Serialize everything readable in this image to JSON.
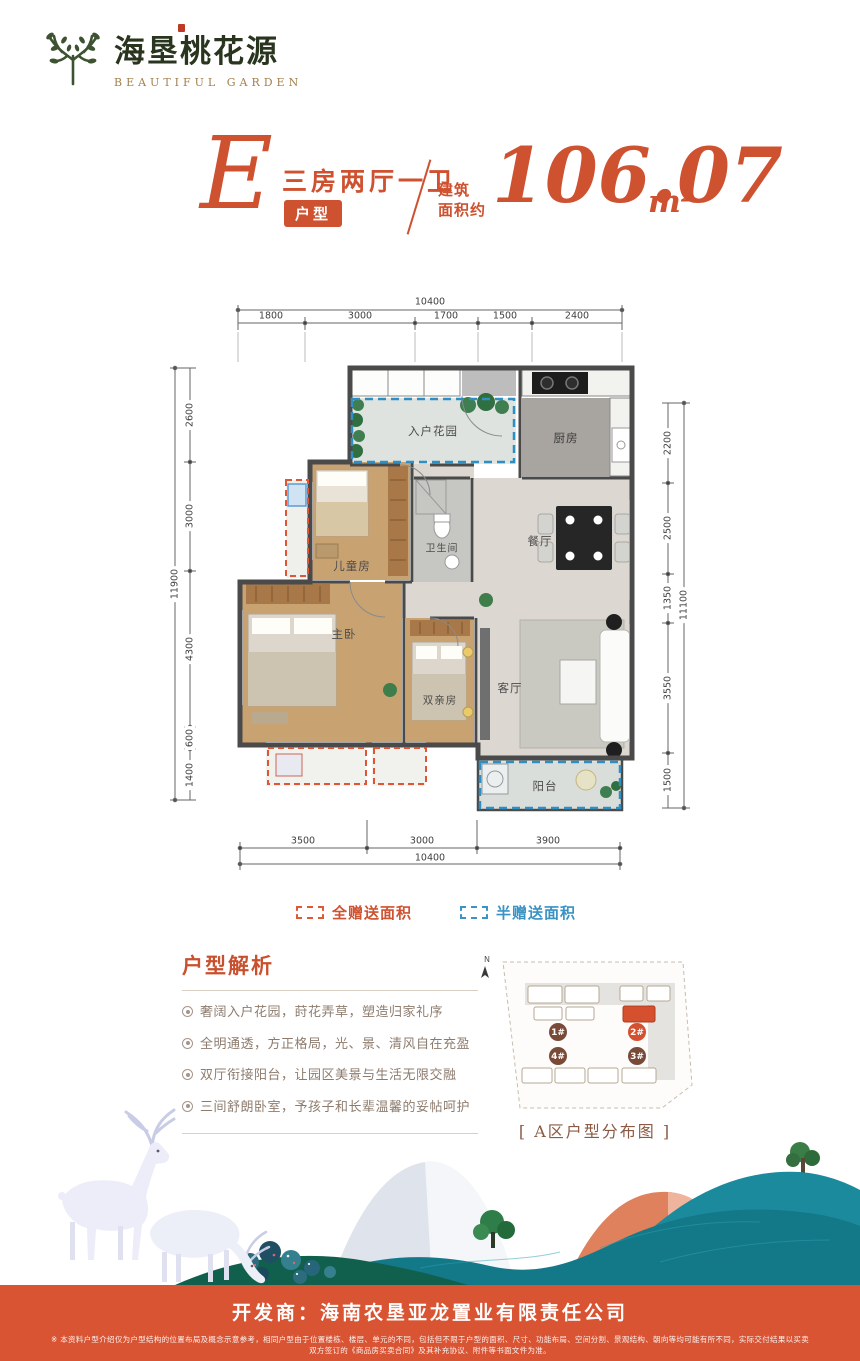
{
  "brand": {
    "name_cn": "海垦桃花源",
    "name_en": "BEAUTIFUL GARDEN"
  },
  "headline": {
    "letter": "E",
    "badge": "户型",
    "rooms_desc": "三房两厅一卫",
    "area_label_line1": "建筑",
    "area_label_line2": "面积约",
    "area_value": "106.07",
    "area_unit": "m²"
  },
  "plan": {
    "rooms": {
      "garden": "入户花园",
      "kitchen": "厨房",
      "kids": "儿童房",
      "bath": "卫生间",
      "dining": "餐厅",
      "master": "主卧",
      "parents": "双亲房",
      "living": "客厅",
      "balcony": "阳台"
    },
    "dims": {
      "top": {
        "total": "10400",
        "segs": [
          "1800",
          "3000",
          "1700",
          "1500",
          "2400"
        ]
      },
      "bottom": {
        "total": "10400",
        "segs": [
          "3500",
          "3000",
          "3900"
        ]
      },
      "left": {
        "total": "11900",
        "segs": [
          "2600",
          "3000",
          "4300",
          "600",
          "1400"
        ]
      },
      "right": {
        "total": "11100",
        "segs": [
          "2200",
          "2500",
          "1350",
          "3550",
          "1500"
        ]
      }
    }
  },
  "legend": {
    "full": "全赠送面积",
    "half": "半赠送面积"
  },
  "analysis": {
    "title": "户型解析",
    "points": [
      "奢阔入户花园，莳花弄草，塑造归家礼序",
      "全明通透，方正格局，光、景、清风自在充盈",
      "双厅衔接阳台，让园区美景与生活无限交融",
      "三间舒朗卧室，予孩子和长辈温馨的妥帖呵护"
    ]
  },
  "siteplan": {
    "north": "N",
    "buildings": [
      "1#",
      "2#",
      "3#",
      "4#"
    ],
    "caption": "[ A区户型分布图 ]"
  },
  "footer": {
    "developer": "开发商：海南农垦亚龙置业有限责任公司",
    "disclaimer": "※ 本资料户型介绍仅为户型结构的位置布局及概念示意参考，相同户型由于位置楼栋、楼层、单元的不同，包括但不限于户型的面积、尺寸、功能布局、空间分割、景观结构、朝向等均可能有所不同，实际交付结果以买卖双方签订的《商品房买卖合同》及其补充协议、附件等书面文件为准。"
  }
}
